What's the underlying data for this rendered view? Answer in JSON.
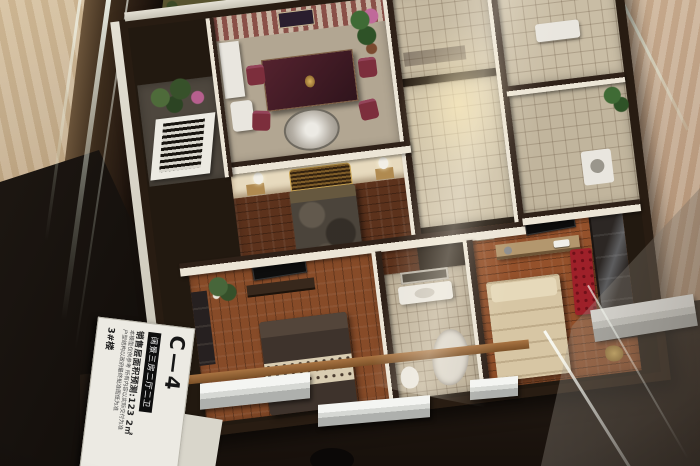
{
  "scene": {
    "subject": "miniature apartment floor-plan scale model displayed inside a glass case on a marble counter"
  },
  "label_card": {
    "unit_code": "C—4",
    "type_banner": "阔景三房二厅二卫",
    "area_line": "销售层面积预测:123 2㎡",
    "disclaimer_line1": "本模型仅供参考 所有内容以实际交付为准",
    "disclaimer_line2": "户型结构以政府最终批准图纸为准",
    "building_no": "3#楼"
  },
  "colors": {
    "marble": "#c9b393",
    "marble2": "#c2a78c",
    "glass": "#e2e9dc",
    "bronze": "#4a3624",
    "base": "#221910",
    "wallface": "#ece5d6",
    "wallcap": "#2f2118",
    "wood-dark": "#5c321c",
    "wood-mid": "#874b28",
    "wood-light": "#94512b",
    "tile": "#c5b9a1",
    "red": "#9e2029",
    "card": "#eceae3"
  }
}
